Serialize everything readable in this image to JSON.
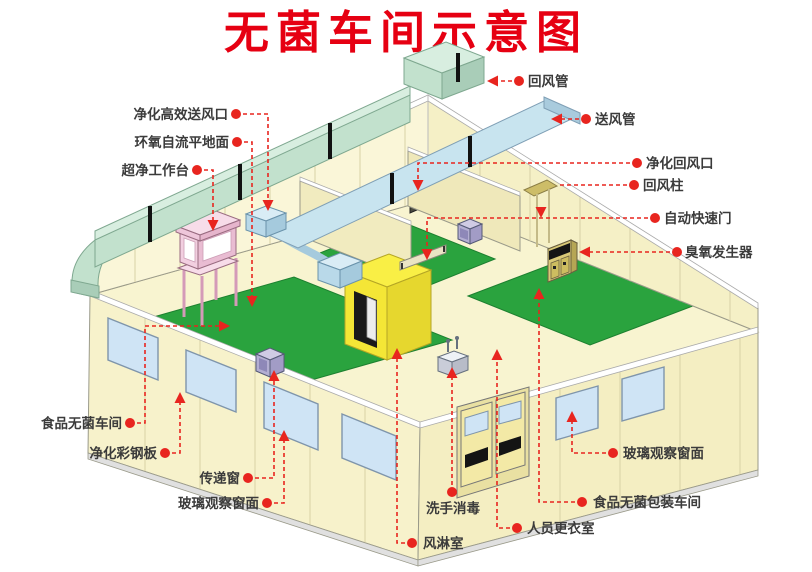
{
  "title": {
    "text": "无菌车间示意图"
  },
  "callouts": [
    {
      "id": "return-air-duct",
      "text": "回风管"
    },
    {
      "id": "supply-air-duct",
      "text": "送风管"
    },
    {
      "id": "purify-return-air-outlet",
      "text": "净化回风口"
    },
    {
      "id": "return-air-column",
      "text": "回风柱"
    },
    {
      "id": "auto-quick-door",
      "text": "自动快速门"
    },
    {
      "id": "ozone-generator",
      "text": "臭氧发生器"
    },
    {
      "id": "hepa-supply-outlet",
      "text": "净化高效送风口"
    },
    {
      "id": "epoxy-self-leveling-floor",
      "text": "环氧自流平地面"
    },
    {
      "id": "ultra-clean-workbench",
      "text": "超净工作台"
    },
    {
      "id": "food-sterile-workshop",
      "text": "食品无菌车间"
    },
    {
      "id": "purify-color-steel-panel",
      "text": "净化彩钢板"
    },
    {
      "id": "pass-window",
      "text": "传递窗"
    },
    {
      "id": "glass-observation-window-left",
      "text": "玻璃观察窗面"
    },
    {
      "id": "hand-wash-disinfect",
      "text": "洗手消毒"
    },
    {
      "id": "air-shower-room",
      "text": "风淋室"
    },
    {
      "id": "staff-changing-room",
      "text": "人员更衣室"
    },
    {
      "id": "food-sterile-packaging-workshop",
      "text": "食品无菌包装车间"
    },
    {
      "id": "glass-observation-window-right",
      "text": "玻璃观察窗面"
    }
  ],
  "colors": {
    "accent_red": "#e8251f",
    "title_red": "#e60012",
    "wall_cream": "#f8f4d2",
    "floor_green": "#2aa33e",
    "return_duct_green": "#c2e1cd",
    "supply_duct_blue": "#c8e4ef",
    "air_shower_yellow": "#f6ea3c",
    "workbench_pink": "#f5d5e4",
    "window_blue": "#cfe4f5",
    "equipment_lavender": "#b3aed2",
    "ozone_cabinet_tan": "#d9c977"
  }
}
